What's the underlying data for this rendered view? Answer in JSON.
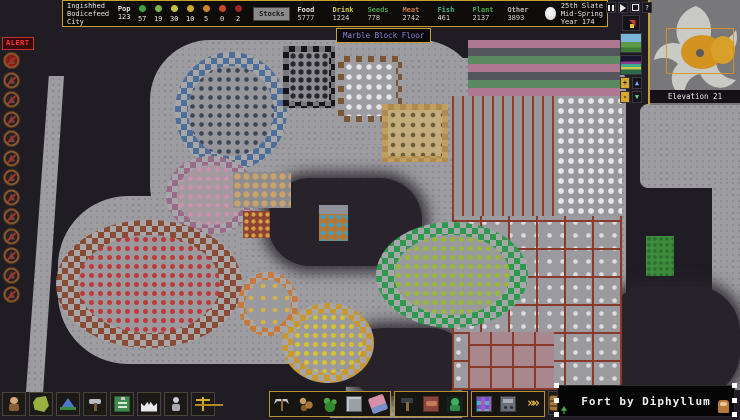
{
  "topbar": {
    "fort_name_lines": [
      "Ingishhed",
      "Bodicefeed",
      "City"
    ],
    "pop": {
      "label": "Pop",
      "total": "123"
    },
    "stress_faces": [
      {
        "color": "#3aa43a",
        "count": "57"
      },
      {
        "color": "#7ab446",
        "count": "19"
      },
      {
        "color": "#c2c23c",
        "count": "30"
      },
      {
        "color": "#d2ac28",
        "count": "10"
      },
      {
        "color": "#d2842c",
        "count": "5"
      },
      {
        "color": "#cc4824",
        "count": "0"
      },
      {
        "color": "#a42222",
        "count": "2"
      }
    ],
    "stocks_button": "Stocks",
    "resources": [
      {
        "label": "Food",
        "color": "#e8e8e8",
        "value": "5777"
      },
      {
        "label": "Drink",
        "color": "#d8d048",
        "value": "1224"
      },
      {
        "label": "Seeds",
        "color": "#49a049",
        "value": "778"
      },
      {
        "label": "Meat",
        "color": "#d07a40",
        "value": "2742"
      },
      {
        "label": "Fish",
        "color": "#44b89a",
        "value": "461"
      },
      {
        "label": "Plant",
        "color": "#4aa84a",
        "value": "2137"
      },
      {
        "label": "Other",
        "color": "#b8b8b8",
        "value": "3893"
      }
    ],
    "date_lines": [
      "25th Slate",
      "Mid-Spring",
      "Year 174"
    ]
  },
  "tooltip": {
    "text": "Marble Block Floor",
    "text_color": "#8f7fd8"
  },
  "controls": {
    "help_label": "?",
    "zoom_in_label": "+",
    "zoom_out_label": "-",
    "z_up_label": "▲",
    "z_down_label": "▼"
  },
  "minimap": {
    "elevation_label": "Elevation 21"
  },
  "sidebar": {
    "alert_label": "ALERT",
    "icons": [
      {
        "name": "danger-alert-icon",
        "variant": "red"
      },
      {
        "name": "no-work-alert-icon"
      },
      {
        "name": "mining-alert-icon"
      },
      {
        "name": "records-alert-icon"
      },
      {
        "name": "military-alert-icon"
      },
      {
        "name": "grate-alert-icon"
      },
      {
        "name": "dig-alert-icon"
      },
      {
        "name": "blood-alert-icon"
      },
      {
        "name": "trade-alert-icon"
      },
      {
        "name": "combat-alert-icon"
      },
      {
        "name": "armor-alert-icon"
      },
      {
        "name": "death-alert-icon"
      },
      {
        "name": "labor-alert-icon"
      }
    ]
  },
  "toolbar_left": {
    "buttons": [
      {
        "name": "citizens-button",
        "icon": "citizens"
      },
      {
        "name": "tasks-button",
        "icon": "tasks"
      },
      {
        "name": "places-button",
        "icon": "places"
      },
      {
        "name": "labor-button",
        "icon": "labor"
      },
      {
        "name": "work-orders-button",
        "icon": "orders"
      },
      {
        "name": "nobles-button",
        "icon": "nobles"
      },
      {
        "name": "objects-button",
        "icon": "objects"
      },
      {
        "name": "justice-button",
        "icon": "justice"
      }
    ]
  },
  "toolbar_center": {
    "groups": [
      {
        "buttons": [
          {
            "name": "dig-button",
            "icon": "pick"
          },
          {
            "name": "chop-button",
            "icon": "wood"
          },
          {
            "name": "gather-button",
            "icon": "plant"
          },
          {
            "name": "smooth-button",
            "icon": "smooth"
          },
          {
            "name": "erase-button",
            "icon": "erase"
          }
        ]
      },
      {
        "buttons": [
          {
            "name": "build-button",
            "icon": "build"
          },
          {
            "name": "zones-button",
            "icon": "zone"
          },
          {
            "name": "burrows-button",
            "icon": "burrow"
          }
        ]
      },
      {
        "buttons": [
          {
            "name": "stockpiles-button",
            "icon": "stockpile"
          },
          {
            "name": "hauling-button",
            "icon": "haul"
          },
          {
            "name": "more-options-button",
            "icon": "more"
          }
        ]
      }
    ],
    "extra_button": {
      "name": "stocks-barrel-button",
      "icon": "barrel"
    }
  },
  "overlay": {
    "text": "Fort by Diphyllum"
  },
  "map": {
    "rooms": [
      {
        "name": "farm-plot-rows",
        "shape": "flat",
        "x": 452,
        "y": 96,
        "w": 104,
        "h": 120,
        "interior": "#98989c",
        "items": "#943a28",
        "pattern": "lines",
        "gap": 10
      },
      {
        "name": "bag-stockpile",
        "shape": "flat",
        "x": 556,
        "y": 96,
        "w": 66,
        "h": 120,
        "interior": "#97979c",
        "items": "#e6e6e8",
        "pattern": "dots",
        "gap": 10,
        "r": 2.6
      },
      {
        "name": "mixed-goods-stockpile",
        "shape": "flat",
        "x": 468,
        "y": 40,
        "w": 152,
        "h": 56,
        "interior": "#8c8c90",
        "pattern": "mosaic",
        "c1": "#b07890",
        "c2": "#5c8a60",
        "c3": "#55555e"
      },
      {
        "name": "storeroom-complex",
        "shape": "flat",
        "x": 452,
        "y": 216,
        "w": 170,
        "h": 174,
        "interior": "#9b9b9f",
        "walls": "#8a3a2a",
        "items": "#dcdcde",
        "pattern": "grid",
        "cell": 28,
        "gap": 13,
        "r": 2
      },
      {
        "name": "pink-room",
        "shape": "flat",
        "x": 468,
        "y": 332,
        "w": 86,
        "h": 58,
        "interior": "#a8888e",
        "walls": "#8a3a2a",
        "pattern": "grid",
        "cell": 22
      },
      {
        "name": "blue-circle-stockpile",
        "shape": "ellipse",
        "x": 175,
        "y": 52,
        "w": 112,
        "h": 118,
        "ring": "#4e6e9a",
        "interior": "#96969a",
        "items": "#3c4456",
        "gap": 9,
        "r": 2
      },
      {
        "name": "tomb-room",
        "shape": "rect",
        "x": 283,
        "y": 46,
        "w": 52,
        "h": 62,
        "ring": "#17151a",
        "ringAlt": "#77777c",
        "interior": "#8f8f93",
        "items": "#2a2730",
        "gap": 8,
        "r": 2.4
      },
      {
        "name": "dining-hall",
        "shape": "rect",
        "x": 338,
        "y": 56,
        "w": 64,
        "h": 66,
        "ring": "#7a5636",
        "ringAlt": "#9d9da1",
        "interior": "#9d9da1",
        "items": "#e4e4e6",
        "gap": 10,
        "r": 2.4
      },
      {
        "name": "bedroom-suite",
        "shape": "rect",
        "x": 382,
        "y": 104,
        "w": 66,
        "h": 58,
        "ring": "#b08a50",
        "ringAlt": "#c0a060",
        "interior": "#c4ad7c",
        "items": "#6f5c38",
        "gap": 10,
        "r": 2
      },
      {
        "name": "purple-circle-stockpile",
        "shape": "ellipse",
        "x": 166,
        "y": 156,
        "w": 90,
        "h": 78,
        "ring": "#9a6a8a",
        "interior": "#a39aa0",
        "items": "#cf8fae",
        "gap": 9,
        "r": 2
      },
      {
        "name": "barrel-stockpile",
        "shape": "flat",
        "x": 233,
        "y": 172,
        "w": 58,
        "h": 36,
        "interior": "#8d8d90",
        "items": "#caa26a",
        "pattern": "dots",
        "gap": 9,
        "r": 2.8
      },
      {
        "name": "red-circle-stockpile",
        "shape": "ellipse",
        "x": 56,
        "y": 220,
        "w": 186,
        "h": 128,
        "ring": "#8a4a34",
        "interior": "#9a9a9e",
        "items": "#c03838",
        "gap": 9,
        "r": 2.2
      },
      {
        "name": "orange-circle-stockpile",
        "shape": "ellipse",
        "x": 238,
        "y": 272,
        "w": 60,
        "h": 64,
        "ring": "#c87838",
        "interior": "#9a9a9e",
        "items": "#d8b048",
        "gap": 12,
        "r": 2
      },
      {
        "name": "gold-circle-stockpile",
        "shape": "ellipse",
        "x": 282,
        "y": 303,
        "w": 92,
        "h": 80,
        "ring": "#c8982e",
        "interior": "#9a9a9e",
        "items": "#d8c030",
        "gap": 9,
        "r": 2.2
      },
      {
        "name": "green-circle-stockpile",
        "shape": "ellipse",
        "x": 376,
        "y": 222,
        "w": 152,
        "h": 106,
        "ring": "#2e9a50",
        "interior": "#9a9a9e",
        "items": "#9ab832",
        "gap": 9,
        "r": 2.2
      },
      {
        "name": "craft-workshop",
        "shape": "flat",
        "x": 243,
        "y": 211,
        "w": 27,
        "h": 27,
        "interior": "#8c4434",
        "items": "#d8a040",
        "pattern": "dots",
        "gap": 7,
        "r": 1.8
      },
      {
        "name": "trade-depot",
        "shape": "flat",
        "x": 319,
        "y": 205,
        "w": 29,
        "h": 36,
        "interior": "#b2783a",
        "pattern": "depot"
      },
      {
        "name": "grass-patch",
        "shape": "flat",
        "x": 646,
        "y": 236,
        "w": 28,
        "h": 40,
        "interior": "#3d8c3c",
        "items": "#2f6e2f",
        "pattern": "dots",
        "gap": 6,
        "r": 1.5
      }
    ]
  }
}
